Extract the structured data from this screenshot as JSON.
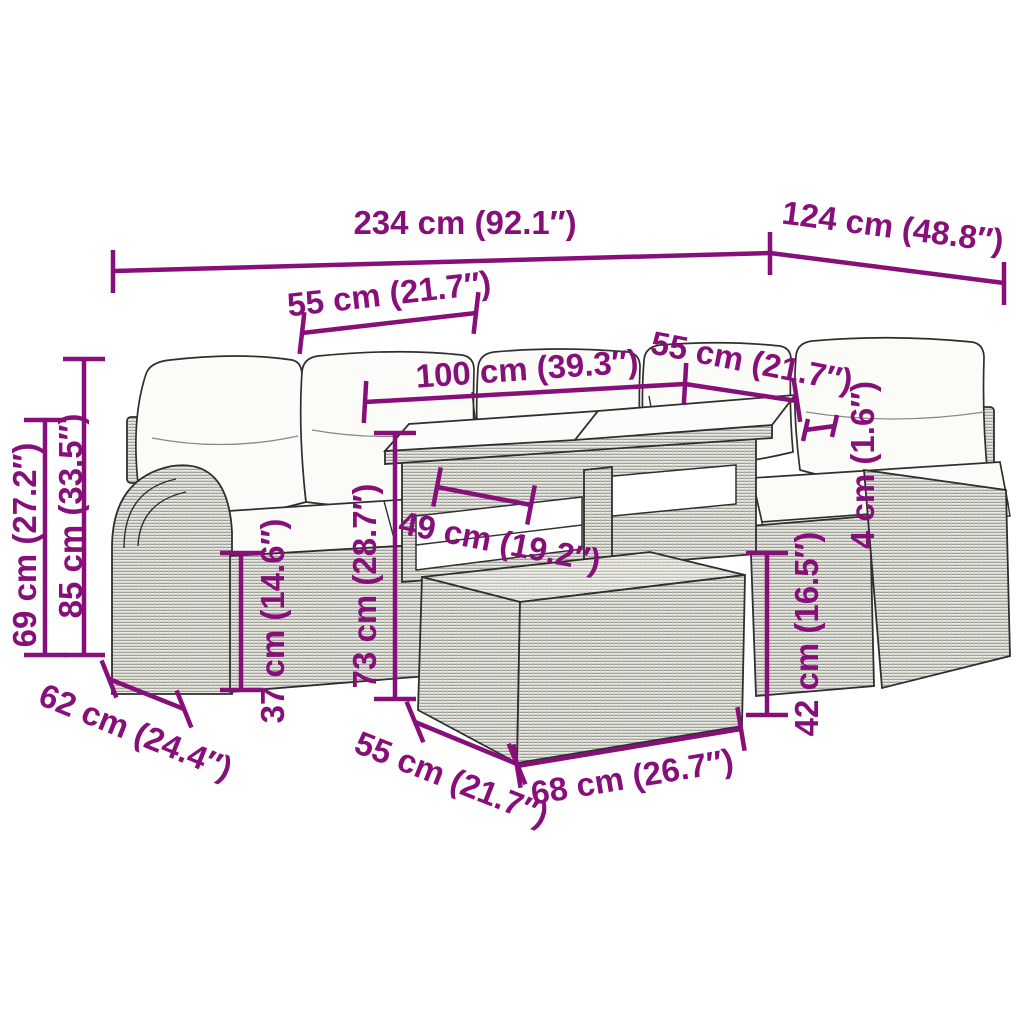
{
  "diagram": {
    "type": "product-dimension-diagram",
    "subject": "6-piece rattan garden lounge set with cushions, glass-top table and ottoman"
  },
  "colors": {
    "dimension_magenta": "#870F7A",
    "furniture_outline": "#2f2f2f",
    "cushion_white": "#fbfbf8",
    "rattan_gray": "#eeeee8",
    "weave_line": "#90908a",
    "background": "#ffffff"
  },
  "dims": {
    "total_width": "234 cm (92.1″)",
    "total_depth": "124 cm (48.8″)",
    "left_seat_width": "55 cm (21.7″)",
    "table_length": "100 cm (39.3″)",
    "right_seat_width": "55 cm (21.7″)",
    "top_thickness": "4 cm (1.6″)",
    "armrest_height": "69 cm (27.2″)",
    "back_height": "85 cm (33.5″)",
    "seat_height": "37 cm (14.6″)",
    "table_height": "73 cm (28.7″)",
    "table_shelf": "49 cm (19.2″)",
    "ottoman_height": "42 cm (16.5″)",
    "seat_depth": "62 cm (24.4″)",
    "ottoman_depth": "55 cm (21.7″)",
    "ottoman_width": "68 cm (26.7″)"
  }
}
